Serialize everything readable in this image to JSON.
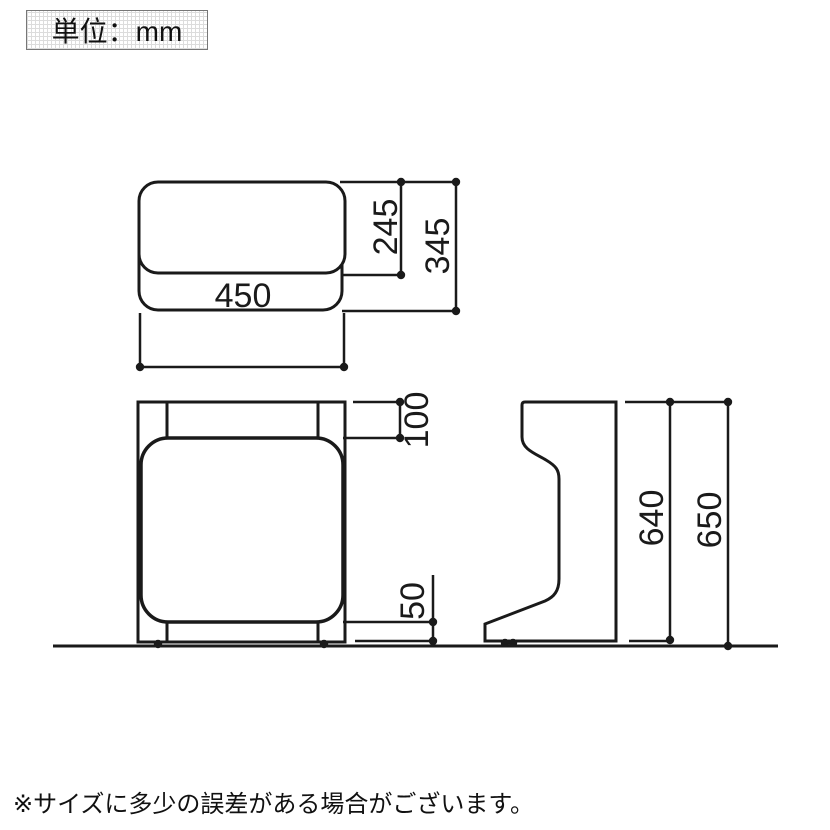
{
  "unit_box": {
    "label": "単位：mm"
  },
  "footnote": {
    "text": "※サイズに多少の誤差がある場合がございます。"
  },
  "dimensions": {
    "top_view": {
      "seat_width": "450",
      "seat_depth": "245",
      "overall_depth": "345"
    },
    "front_view": {
      "top_frame_height": "100",
      "bottom_clearance": "50"
    },
    "side_view": {
      "body_height": "640",
      "overall_height": "650"
    }
  },
  "colors": {
    "line": "#1a1a1a",
    "box_border": "#777777",
    "box_grid": "#dcdcdc",
    "background": "#ffffff"
  }
}
